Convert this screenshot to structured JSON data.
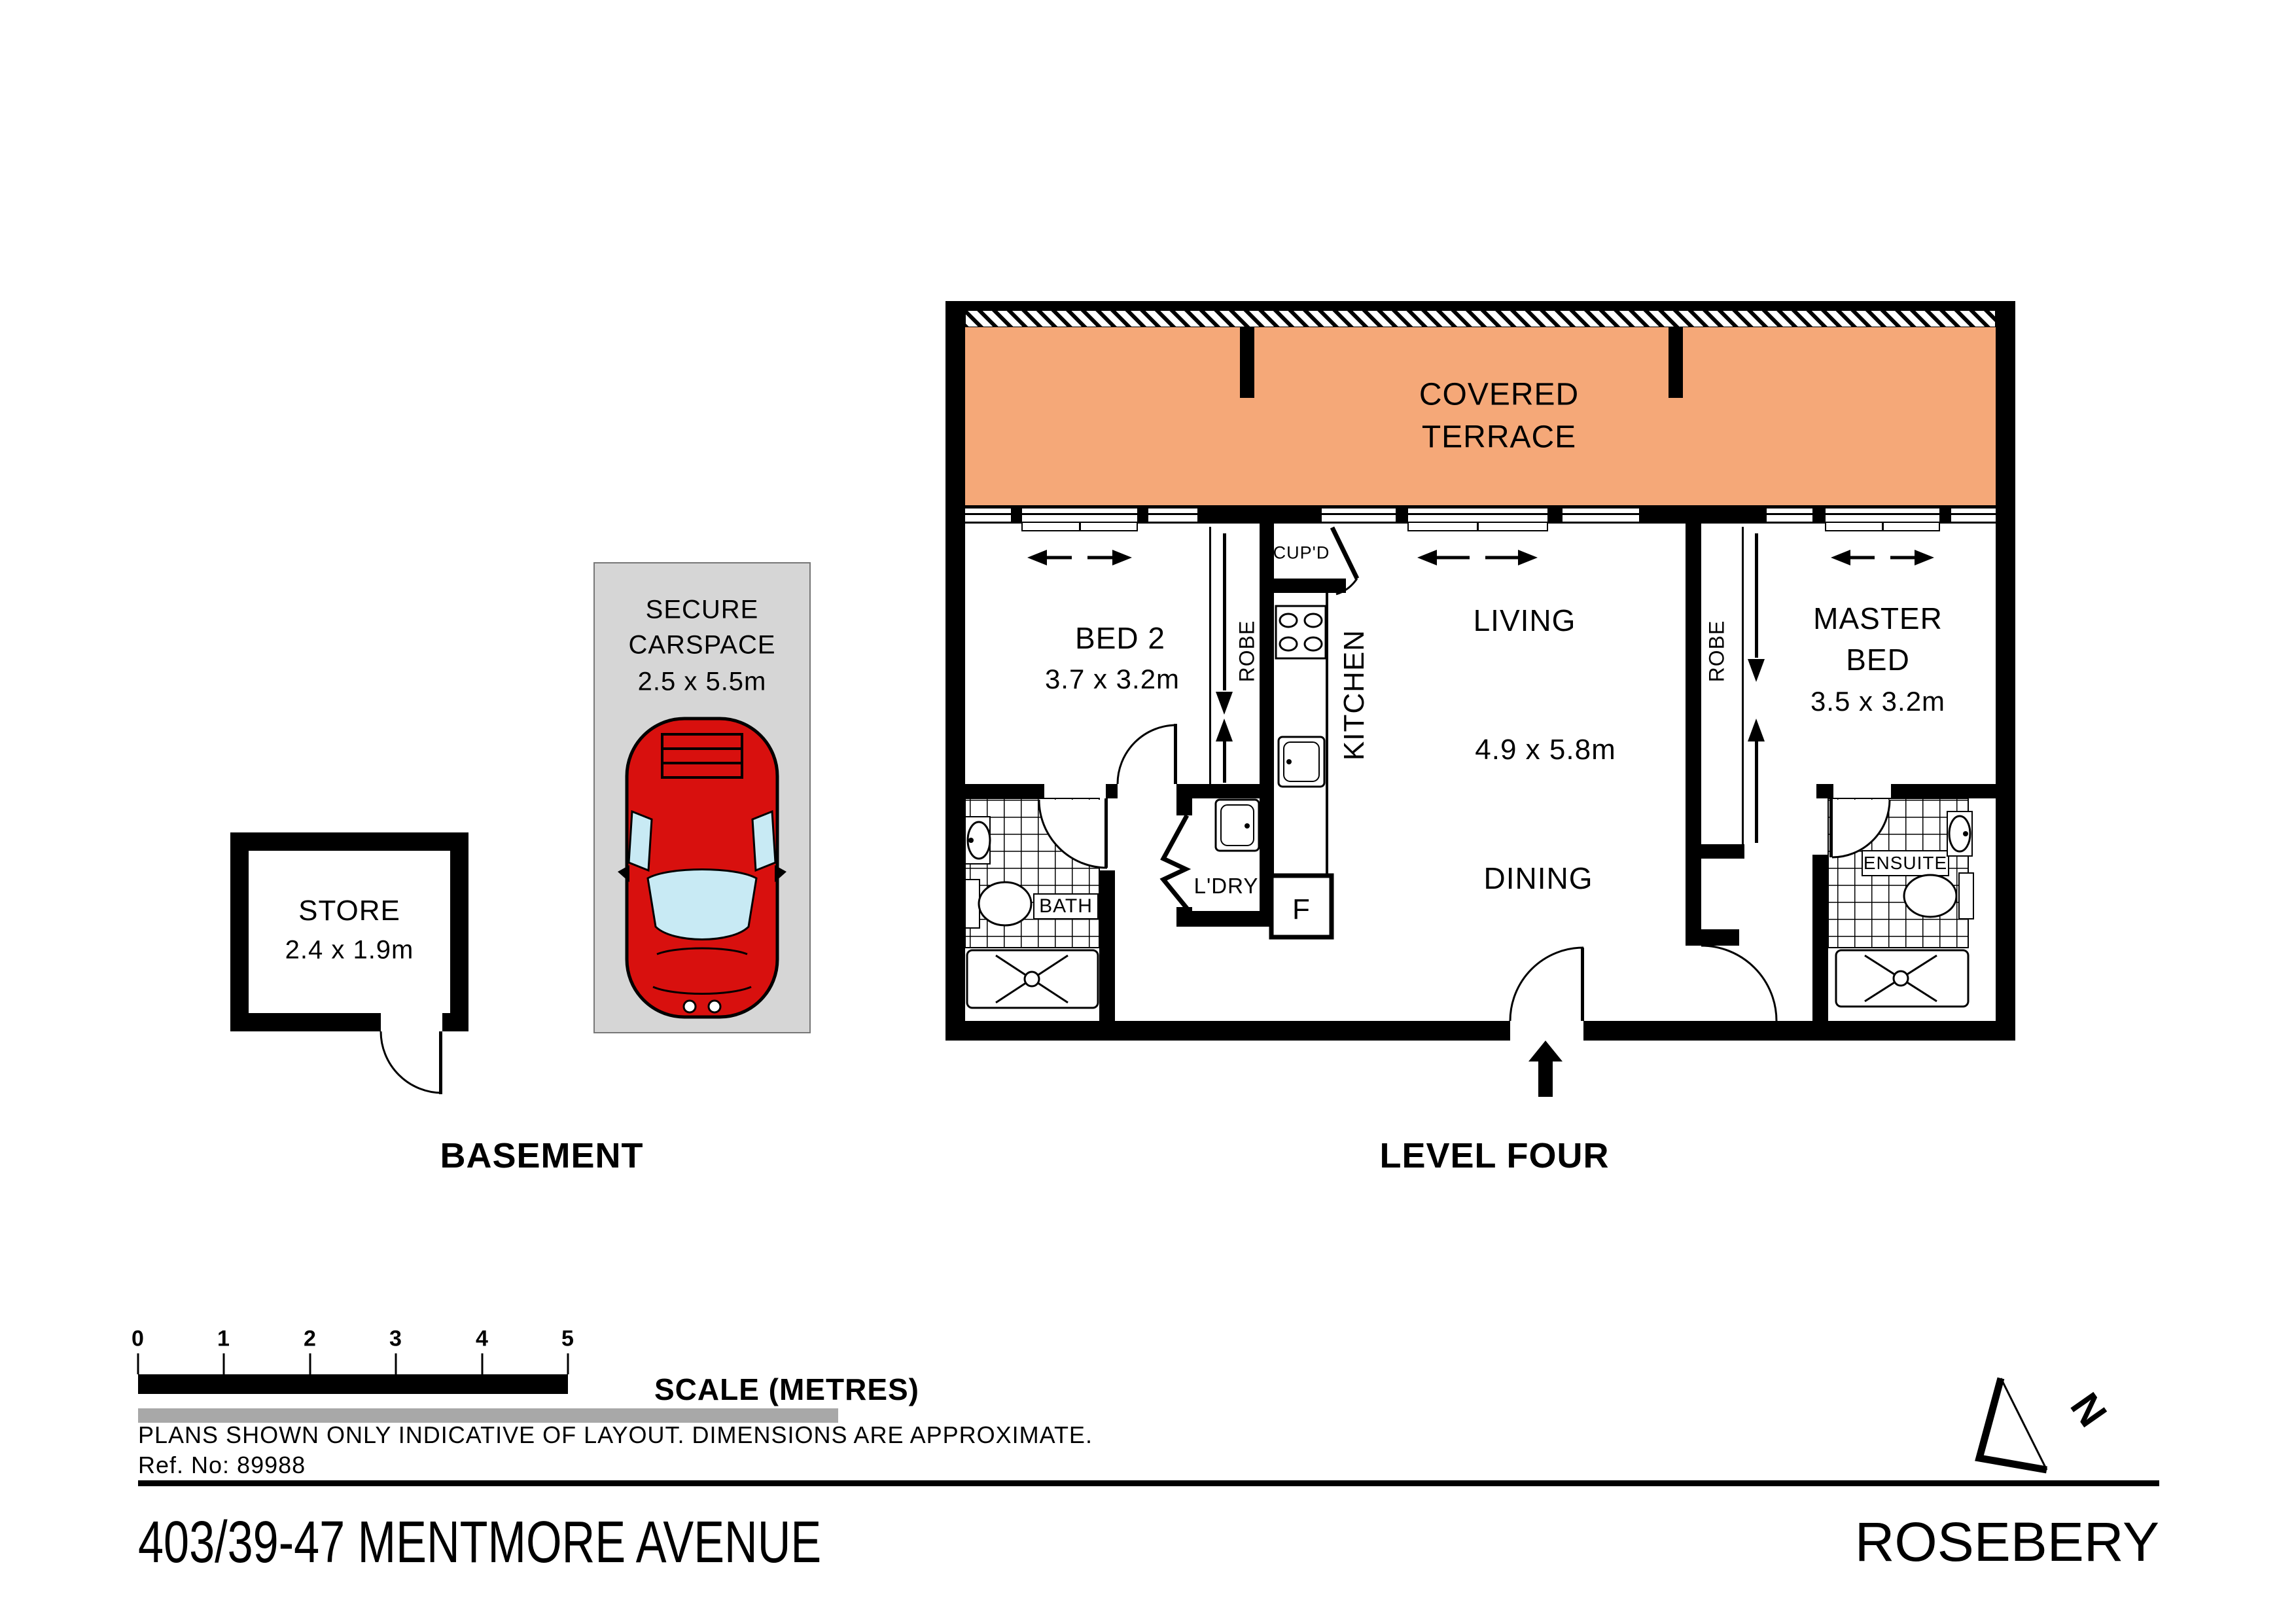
{
  "colors": {
    "terrace_fill": "#F5A878",
    "carspace_fill": "#D6D6D6",
    "car_body": "#D8100E",
    "car_glass": "#C8EAF4",
    "scale_gray_bar": "#A8A8A8",
    "line_black": "#000000"
  },
  "plan": {
    "terrace": {
      "line1": "COVERED",
      "line2": "TERRACE"
    },
    "bed2": {
      "name": "BED 2",
      "dims": "3.7 x 3.2m",
      "robe": "ROBE"
    },
    "kitchen": {
      "name": "KITCHEN",
      "cupboard": "CUP'D",
      "fridge": "F"
    },
    "living": {
      "name": "LIVING",
      "dims": "4.9 x 5.8m"
    },
    "dining": {
      "name": "DINING"
    },
    "master": {
      "line1": "MASTER",
      "line2": "BED",
      "dims": "3.5 x 3.2m",
      "robe": "ROBE"
    },
    "laundry": {
      "name": "L'DRY"
    },
    "bath": {
      "name": "BATH"
    },
    "ensuite": {
      "name": "ENSUITE"
    }
  },
  "basement": {
    "store": {
      "name": "STORE",
      "dims": "2.4 x 1.9m"
    },
    "carspace": {
      "line1": "SECURE",
      "line2": "CARSPACE",
      "dims": "2.5 x 5.5m"
    }
  },
  "section_titles": {
    "basement": "BASEMENT",
    "level": "LEVEL FOUR"
  },
  "scale_bar": {
    "numbers": [
      "0",
      "1",
      "2",
      "3",
      "4",
      "5"
    ],
    "title": "SCALE (METRES)"
  },
  "notes": {
    "disclaimer": "PLANS SHOWN ONLY INDICATIVE OF LAYOUT.  DIMENSIONS ARE APPROXIMATE.",
    "ref": "Ref. No: 89988"
  },
  "footer": {
    "address": "403/39-47 MENTMORE AVENUE",
    "suburb": "ROSEBERY"
  },
  "compass": {
    "letter": "N"
  }
}
